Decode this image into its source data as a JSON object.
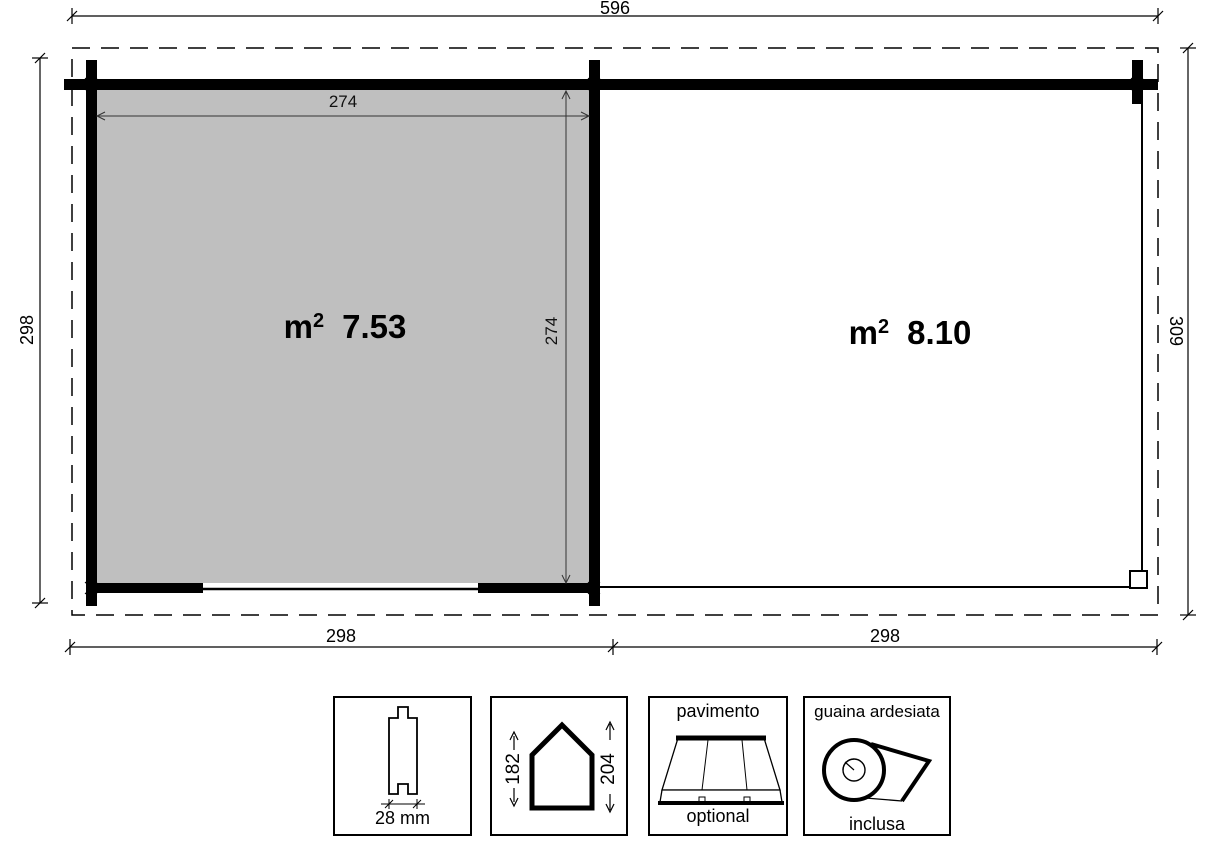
{
  "plan": {
    "overall_width": "596",
    "left_depth": "298",
    "right_depth": "309",
    "bottom_left_width": "298",
    "bottom_right_width": "298",
    "left_room": {
      "unit": "m",
      "sup": "2",
      "area": "7.53",
      "inner_width": "274",
      "inner_depth": "274"
    },
    "right_room": {
      "unit": "m",
      "sup": "2",
      "area": "8.10"
    }
  },
  "legend": {
    "boxes": [
      {
        "icon": "wall-plank-profile-icon",
        "label": "28 mm"
      },
      {
        "icon": "house-height-icon",
        "eave_height": "182",
        "ridge_height": "204"
      },
      {
        "icon": "floor-boards-icon",
        "title": "pavimento",
        "note": "optional"
      },
      {
        "icon": "roofing-felt-roll-icon",
        "title": "guaina ardesiata",
        "note": "inclusa"
      }
    ]
  },
  "colors": {
    "room_fill": "#bfbfbf",
    "line": "#000000"
  }
}
